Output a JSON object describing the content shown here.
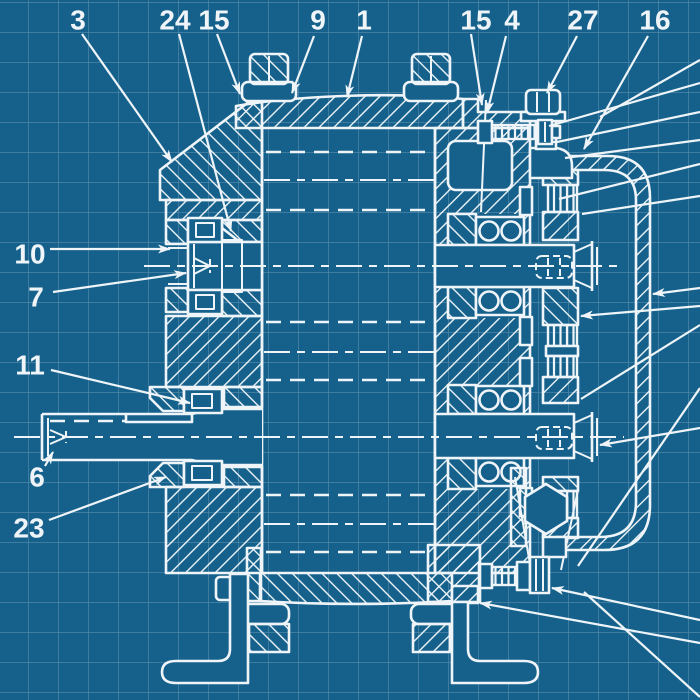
{
  "figure": {
    "kind": "blueprint technical drawing",
    "subject": "gear reducer cross-section with numbered part callouts",
    "canvas": {
      "width": 700,
      "height": 700
    }
  },
  "colors": {
    "background": "#15618c",
    "grid": "#4d85a6",
    "line": "#eef4f7"
  },
  "grid": {
    "spacing": 30,
    "offset_x": 28,
    "offset_y": 2
  },
  "callouts": [
    {
      "label": "3",
      "x": 78,
      "y": 20,
      "leader": {
        "x1": 82,
        "y1": 34,
        "x2": 172,
        "y2": 162,
        "arrow": true
      }
    },
    {
      "label": "24",
      "x": 175,
      "y": 20,
      "leader": {
        "x1": 179,
        "y1": 34,
        "x2": 231,
        "y2": 231,
        "arrow": true
      }
    },
    {
      "label": "15",
      "x": 214,
      "y": 20,
      "leader": {
        "x1": 217,
        "y1": 34,
        "x2": 240,
        "y2": 94,
        "arrow": true
      }
    },
    {
      "label": "9",
      "x": 318,
      "y": 20,
      "leader": {
        "x1": 314,
        "y1": 36,
        "x2": 292,
        "y2": 93,
        "arrow": true
      }
    },
    {
      "label": "1",
      "x": 364,
      "y": 20,
      "leader": {
        "x1": 362,
        "y1": 36,
        "x2": 347,
        "y2": 97,
        "arrow": true
      }
    },
    {
      "label": "15",
      "x": 476,
      "y": 20,
      "leader": {
        "x1": 471,
        "y1": 34,
        "x2": 482,
        "y2": 105,
        "arrow": true
      }
    },
    {
      "label": "4",
      "x": 512,
      "y": 20,
      "leader": {
        "x1": 506,
        "y1": 36,
        "x2": 487,
        "y2": 113,
        "arrow": true
      }
    },
    {
      "label": "27",
      "x": 583,
      "y": 20,
      "leader": {
        "x1": 577,
        "y1": 36,
        "x2": 547,
        "y2": 93,
        "arrow": true
      }
    },
    {
      "label": "16",
      "x": 655,
      "y": 20,
      "leader": {
        "x1": 648,
        "y1": 36,
        "x2": 584,
        "y2": 149,
        "arrow": true
      }
    },
    {
      "label": "10",
      "x": 30,
      "y": 254,
      "leader": {
        "x1": 50,
        "y1": 249,
        "x2": 170,
        "y2": 249,
        "arrow": true
      }
    },
    {
      "label": "7",
      "x": 36,
      "y": 297,
      "leader": {
        "x1": 53,
        "y1": 292,
        "x2": 186,
        "y2": 273,
        "arrow": true
      }
    },
    {
      "label": "11",
      "x": 30,
      "y": 365,
      "leader": {
        "x1": 51,
        "y1": 370,
        "x2": 190,
        "y2": 403,
        "arrow": true
      }
    },
    {
      "label": "6",
      "x": 37,
      "y": 477,
      "leader": {
        "x1": 45,
        "y1": 466,
        "x2": 53,
        "y2": 452,
        "arrow": true
      }
    },
    {
      "label": "23",
      "x": 29,
      "y": 528,
      "leader": {
        "x1": 49,
        "y1": 520,
        "x2": 166,
        "y2": 477,
        "arrow": true
      }
    }
  ],
  "edge_leaders": [
    {
      "tip": {
        "x": 549,
        "y": 126
      },
      "end": {
        "x": 700,
        "y": 83
      },
      "arrow": false
    },
    {
      "tip": {
        "x": 557,
        "y": 142
      },
      "end": {
        "x": 700,
        "y": 112
      },
      "arrow": false
    },
    {
      "tip": {
        "x": 565,
        "y": 158
      },
      "end": {
        "x": 700,
        "y": 140
      },
      "arrow": false
    },
    {
      "tip": {
        "x": 559,
        "y": 199
      },
      "end": {
        "x": 700,
        "y": 164
      },
      "arrow": false
    },
    {
      "tip": {
        "x": 582,
        "y": 214
      },
      "end": {
        "x": 700,
        "y": 196
      },
      "arrow": false
    },
    {
      "tip": {
        "x": 600,
        "y": 117
      },
      "end": {
        "x": 700,
        "y": 60
      },
      "arrow": false
    },
    {
      "tip": {
        "x": 653,
        "y": 294
      },
      "end": {
        "x": 700,
        "y": 288
      },
      "arrow": true
    },
    {
      "tip": {
        "x": 581,
        "y": 316
      },
      "end": {
        "x": 700,
        "y": 306
      },
      "arrow": true
    },
    {
      "tip": {
        "x": 581,
        "y": 399
      },
      "end": {
        "x": 700,
        "y": 325
      },
      "arrow": false
    },
    {
      "tip": {
        "x": 600,
        "y": 445
      },
      "end": {
        "x": 700,
        "y": 428
      },
      "arrow": true
    },
    {
      "tip": {
        "x": 552,
        "y": 588
      },
      "end": {
        "x": 700,
        "y": 620
      },
      "arrow": true
    },
    {
      "tip": {
        "x": 480,
        "y": 603
      },
      "end": {
        "x": 700,
        "y": 643
      },
      "arrow": true
    },
    {
      "tip": {
        "x": 584,
        "y": 592
      },
      "end": {
        "x": 700,
        "y": 697
      },
      "arrow": false
    },
    {
      "tip": {
        "x": 578,
        "y": 566
      },
      "end": {
        "x": 700,
        "y": 388
      },
      "arrow": false
    }
  ],
  "hidden_gear_lines_y": [
    152,
    210,
    322,
    380,
    495,
    552
  ],
  "pitch_lines_y": [
    180,
    352,
    524
  ],
  "shaft_axes_y": [
    266,
    437
  ]
}
